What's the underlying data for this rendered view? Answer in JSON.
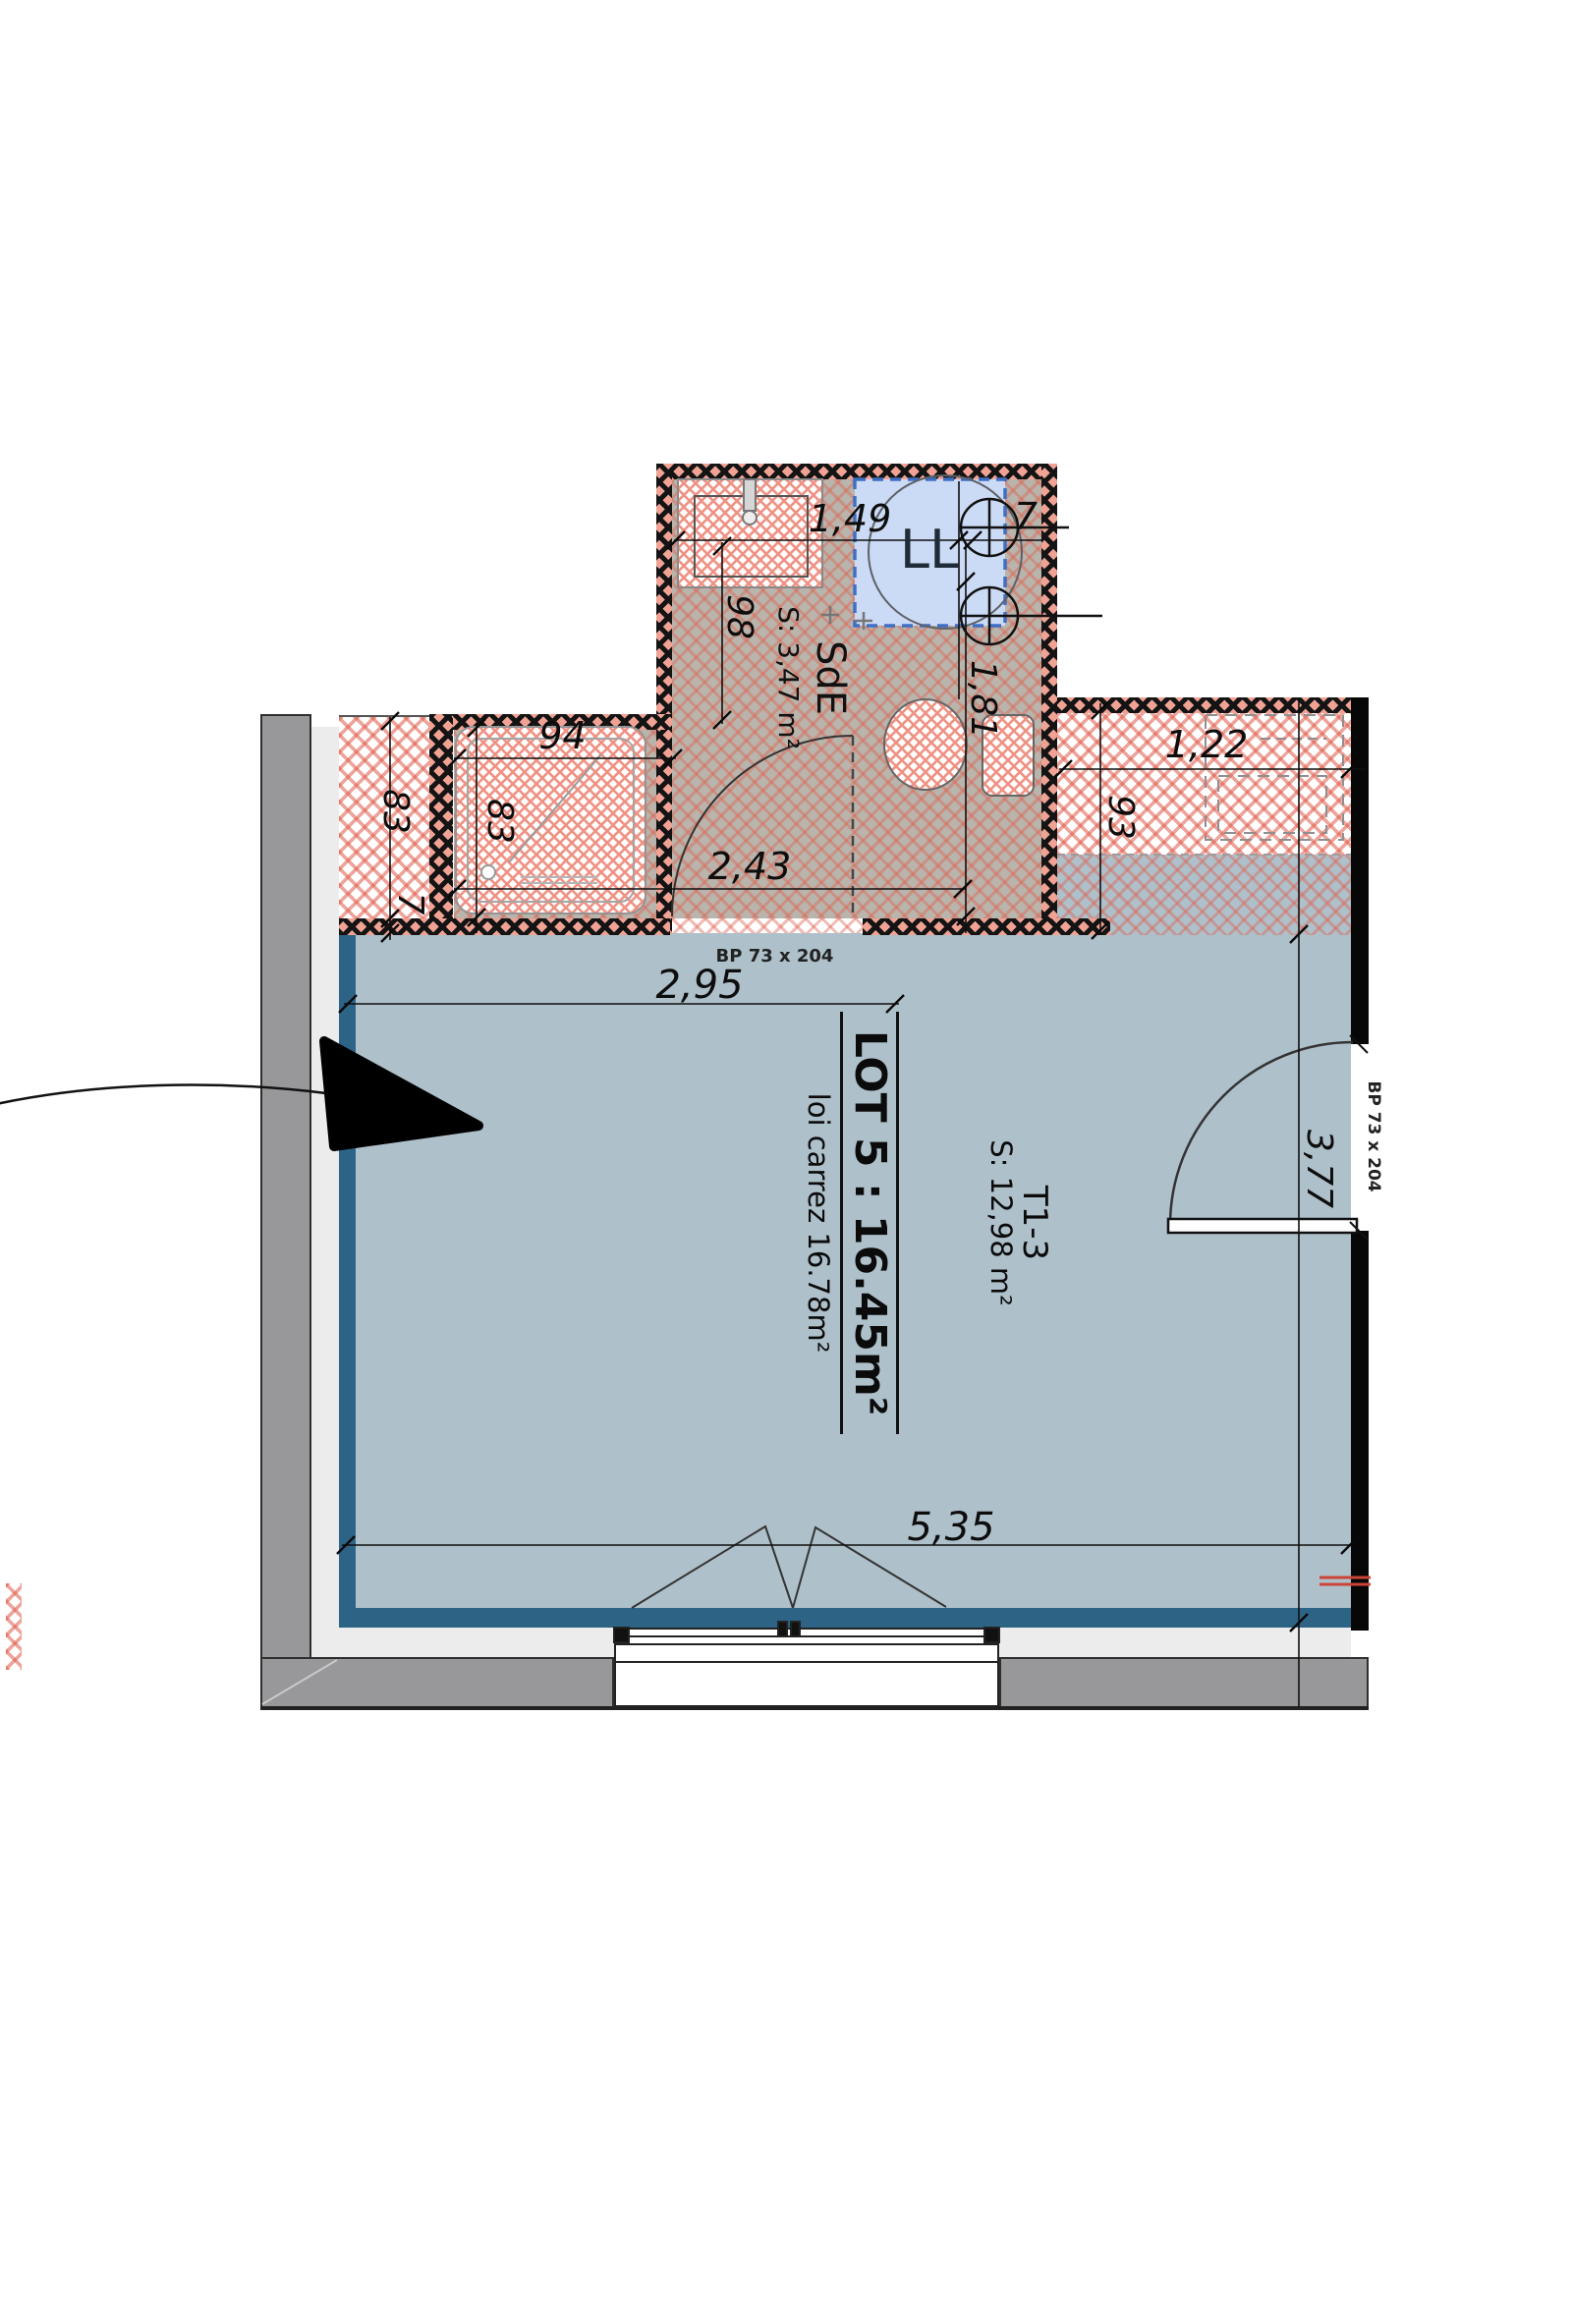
{
  "unit": {
    "lot_label": "LOT 5 : 16.45m²",
    "loi_carrez": "loi carrez 16.78m²",
    "type_label": "T1-3",
    "surface_label": "S: 12,98 m²"
  },
  "bathroom": {
    "name": "SdE",
    "surface": "S: 3,47 m²",
    "washer_label": "LL"
  },
  "doors": {
    "bathroom_door_label": "BP  73 x 204",
    "entrance_door_label": "BP  73 x 204"
  },
  "dimensions": {
    "sink_width": "1,49",
    "sink_offset": "7",
    "sink_depth": "98",
    "shower_width": "94",
    "duct_height": "83",
    "duct_offset": "7",
    "shower_height": "83",
    "bath_width": "2,43",
    "bath_height": "1,81",
    "kitchen_width": "1,22",
    "kitchen_depth": "93",
    "room_width_partial": "2,95",
    "room_height": "3,77",
    "room_width": "5,35"
  },
  "colors": {
    "floor_main": "#aec0ca",
    "floor_accent": "#2d6486",
    "floor_wet": "#b9b4ac",
    "hatch_red": "#e0604e",
    "wall_gray": "#98989a",
    "wall_black": "#070707",
    "washer_fill": "#cbdaf5",
    "washer_border": "#3f6fc4"
  }
}
